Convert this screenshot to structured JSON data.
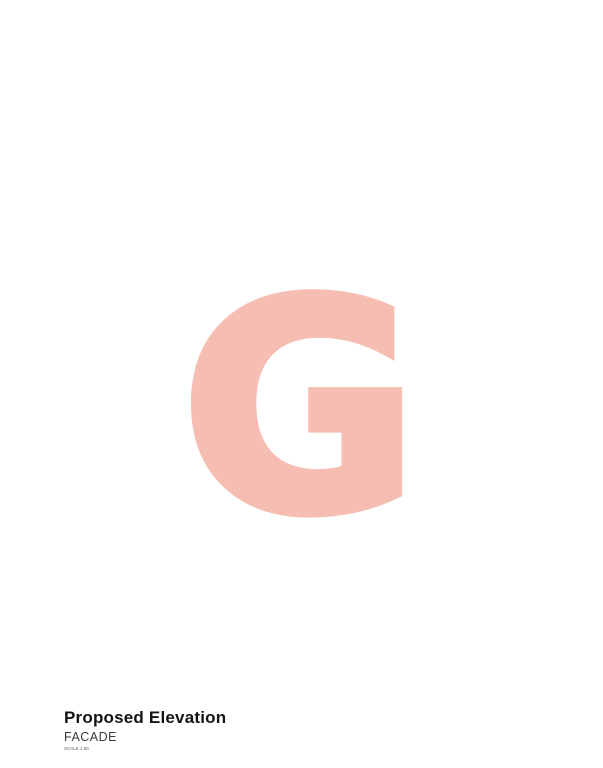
{
  "title_block": {
    "title": "Proposed Elevation",
    "subtitle": "FACADE",
    "scale_note": "SCALE 1:50"
  },
  "watermark": {
    "letter": "G",
    "color": "#f6beb2"
  },
  "annotations": {
    "material_labels": [
      {
        "text": "Travertine cladding"
      },
      {
        "text": "Local flat faced stone"
      },
      {
        "text": "White Apertures"
      },
      {
        "text": "Local flat faced stone"
      },
      {
        "text": "Travertine cladding"
      },
      {
        "text": "Local flat faced stone"
      },
      {
        "text": "White Apertures"
      }
    ],
    "level_labels": [
      "SPC 00",
      "SPC 01"
    ],
    "dimensions": {
      "overall_height": "15300",
      "top_width": "11500",
      "side_secondary": "11500"
    }
  },
  "building": {
    "upper_floors": 3,
    "bays": 3,
    "louvered_windows_per_floor": 2,
    "panels_per_window": 4,
    "circular_windows": 3,
    "ground_floor_doors": 3,
    "balcony_planters_per_floor": 2
  },
  "colors": {
    "structure_gray": "#8f9e9b",
    "plant_dark": "#6f807b",
    "line_gray": "#9aa5a3",
    "louver_line": "#b2bab8",
    "circle_outline": "#39413f",
    "vegetation_greens": [
      "#3f9e3c",
      "#54b24f",
      "#6fc468",
      "#8bd284"
    ],
    "dashed_line": "#3f3f3f",
    "ground_line": "#161616",
    "watermark_pink": "#f6beb2"
  }
}
